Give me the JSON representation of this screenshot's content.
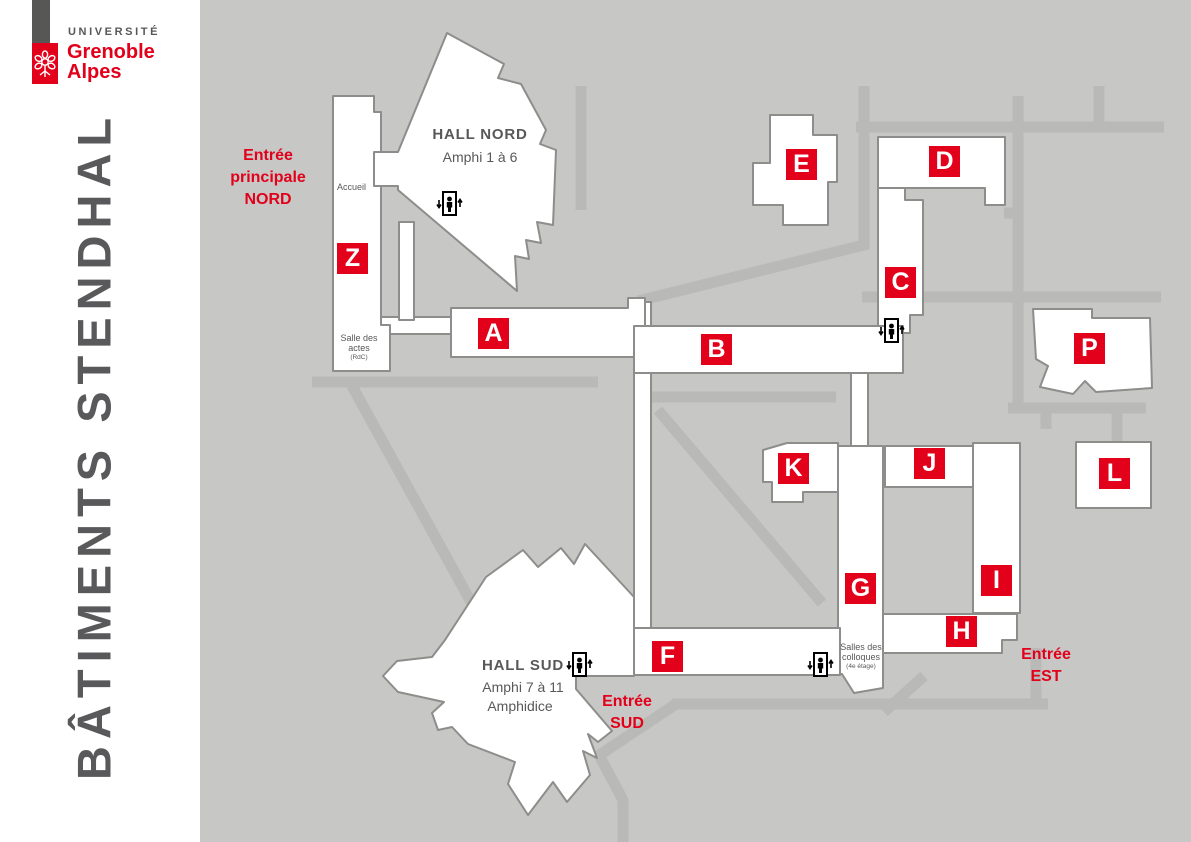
{
  "logo": {
    "line1": "UNIVERSITÉ",
    "line2": "Grenoble",
    "line3": "Alpes"
  },
  "title_vertical": "BÂTIMENTS STENDHAL",
  "map": {
    "colors": {
      "red": "#e2001a",
      "map_background": "#c7c7c5",
      "path_gray": "#b9b9b7",
      "building_fill": "#ffffff",
      "building_stroke": "#8d8d8b",
      "text_gray": "#58585a"
    },
    "halls": {
      "nord": {
        "title": "HALL NORD",
        "subtitle": "Amphi 1 à 6"
      },
      "sud": {
        "title": "HALL SUD",
        "subtitle": "Amphi 7 à 11",
        "subtitle2": "Amphidice"
      }
    },
    "rooms": {
      "accueil": "Accueil",
      "salle_des_actes": {
        "line1": "Salle des",
        "line2": "actes",
        "note": "(RdC)"
      },
      "salles_des_colloques": {
        "line1": "Salles des",
        "line2": "colloques",
        "note": "(4e étage)"
      }
    },
    "entrances": {
      "nord": {
        "line1": "Entrée",
        "line2": "principale",
        "line3": "NORD"
      },
      "sud": {
        "line1": "Entrée",
        "line2": "SUD"
      },
      "est": {
        "line1": "Entrée",
        "line2": "EST"
      }
    },
    "buildings": [
      {
        "letter": "Z"
      },
      {
        "letter": "A"
      },
      {
        "letter": "B"
      },
      {
        "letter": "C"
      },
      {
        "letter": "D"
      },
      {
        "letter": "E"
      },
      {
        "letter": "F"
      },
      {
        "letter": "G"
      },
      {
        "letter": "H"
      },
      {
        "letter": "I"
      },
      {
        "letter": "J"
      },
      {
        "letter": "K"
      },
      {
        "letter": "L"
      },
      {
        "letter": "P"
      }
    ]
  }
}
